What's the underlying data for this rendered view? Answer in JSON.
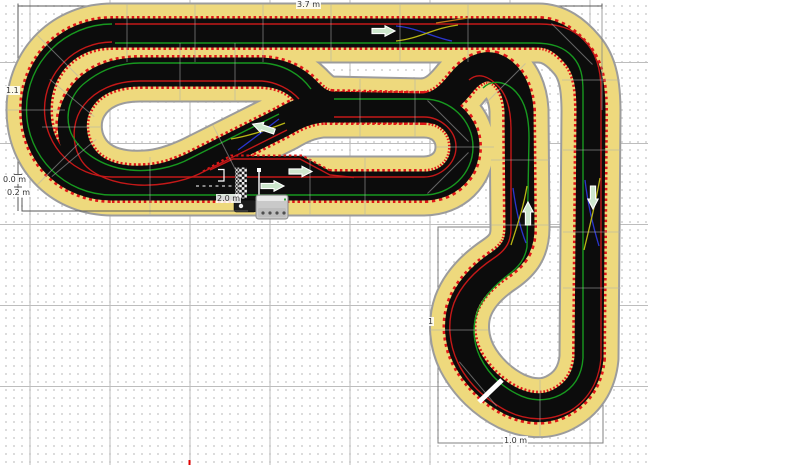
{
  "app": {
    "canvas_name": "slot-car-track-editor-canvas"
  },
  "colors": {
    "border_yellow": "#eed97d",
    "track_black": "#0c0c0c",
    "track_outline": "#9c9c9c",
    "rumble_red": "#e01818",
    "lane_red": "#c41818",
    "lane_green": "#17981f",
    "lanechange_blue": "#2a35cc",
    "lanechange_yellow": "#b9b614",
    "lanechange_orange": "#c07818",
    "arrow_fill": "#cde7cd",
    "dimension_line": "#5a5a5a",
    "selection_rect": "#808080",
    "page_marker_red": "#e00000"
  },
  "dimension_labels": [
    {
      "text": "3.7 m",
      "x": 296,
      "y": 0
    },
    {
      "text": "1.1",
      "x": 5,
      "y": 86
    },
    {
      "text": "0.0 m",
      "x": 2,
      "y": 175
    },
    {
      "text": "0.2 m",
      "x": 6,
      "y": 188
    },
    {
      "text": "2.0 m",
      "x": 216,
      "y": 194
    },
    {
      "text": "1.0 m",
      "x": 503,
      "y": 436
    },
    {
      "text": "1",
      "x": 427,
      "y": 317
    }
  ],
  "track": {
    "main_loop_d": "M 112 186 L 424 186 C 448 186 465 169 465 147 C 465 125 448 108 424 108 L 322 108 C 305 110 295 115 283 122 L 195 166 C 178 174 163 179 146 180 C 112 182 90 172 79 152 C 70 136 70 116 79 101 C 90 82 112 72 140 72 L 262 72 C 282 73 295 80 305 90 C 312 97 318 104 330 106 L 424 108 C 443 106 454 92 462 82 C 472 70 486 62 499 70 C 512 78 518 94 519 110 L 520 228 C 520 246 513 255 500 264 C 482 276 469 290 463 306 C 457 323 459 342 467 358 C 477 377 493 392 511 401 C 528 409 545 410 559 403 C 577 394 587 379 589 358 L 591 112 C 591 86 588 68 577 55 C 566 42 554 33 538 33 L 112 33 C 70 33 36 64 36 110 C 36 156 70 186 112 186 Z",
    "pit_strip_d": "M 203 172 L 231 156 L 302 156 L 332 172 Z",
    "pit_strip_dots_d": "M 203 171.5 L 231 155.5 L 302 155.5 L 332 171.5",
    "pit_red_d": "M 210 170 L 233 159 L 300 159 L 330 175 L 354 177.5",
    "lane_red_paths": [
      "M 115 24 L 540 24 C 558 24 572 28 584 40 C 596 52 601 70 601 90 L 601 358 C 599 382 588 400 570 411 C 549 422 526 421 505 410 C 485 399 468 383 458 363 C 449 344 447 322 454 303 C 461 285 476 270 494 258 C 506 250 511 242 511 228 L 511 130 C 511 112 508 97 499 87 C 489 76 478 72 469 80",
      "M 334 117 L 424 117 C 440 117 456 130 456 147 C 456 164 440 177 424 177 L 112 177 C 75 177 44.5 147 44.5 109.5 C 44.5 72 75 42 112 42",
      "M 287 130 L 199 174 C 182 182 158 186 138 185 C 108 183 86 172 79 156 C 71 140 73 119 84 105 C 95 91 114 81 140 81 L 262 81 C 276 82 290 89 299 99"
    ],
    "lane_green_paths": [
      "M 115 43 L 534 43 C 552 43 564 47 573 57 C 581 66 583 76 583 92 L 583 358 C 582 375 574 388 560 395 C 546 402 530 401 517 394 C 501 386 488 373 480 357 C 473 342 472 325 478 310 C 484 296 495 285 508 275 C 519 267 525 259 527 247 L 529 138 C 529 116 525 102 516 92 C 506 81 492 79 483 88",
      "M 334 99 L 424 99 C 450 99 473 120 473 147 C 473 174 450 195 424 195 L 112 195 C 65 195 26.5 157 26.5 109.5 C 26.5 62 65 24 112 24",
      "M 279 114 L 191 158 C 173 168 150 172 130 170 C 101 167 79 151 71 133 C 64 115 70 94 86 82 C 101 70 118 63 140 63 L 262 63 C 284 64 301 75 311 89"
    ],
    "center_dashes_d": "M 196 186 L 237 186",
    "lane_changes": [
      {
        "color": "lanechange_blue",
        "d": "M 396 26 C 418 28 432 37 452 41"
      },
      {
        "color": "lanechange_yellow",
        "d": "M 396 41 C 418 39 434 28 458 25"
      },
      {
        "color": "lanechange_orange",
        "d": "M 436 23 L 468 18"
      },
      {
        "color": "lanechange_blue",
        "d": "M 513 188 C 516 210 520 228 526 243"
      },
      {
        "color": "lanechange_yellow",
        "d": "M 527 186 C 523 210 516 229 511 245"
      },
      {
        "color": "lanechange_blue",
        "d": "M 585 180 C 588 206 593 226 599 246"
      },
      {
        "color": "lanechange_yellow",
        "d": "M 600 178 C 595 206 589 229 584 250"
      },
      {
        "color": "lanechange_blue",
        "d": "M 238 150 C 252 140 267 128 279 119"
      },
      {
        "color": "lanechange_yellow",
        "d": "M 231 139 C 249 136 267 130 285 123"
      }
    ],
    "joints": [
      {
        "x": 127,
        "y": 33,
        "a": 90
      },
      {
        "x": 195,
        "y": 33,
        "a": 90
      },
      {
        "x": 263,
        "y": 33,
        "a": 90
      },
      {
        "x": 331,
        "y": 33,
        "a": 90
      },
      {
        "x": 400,
        "y": 33,
        "a": 90
      },
      {
        "x": 468,
        "y": 33,
        "a": 90
      },
      {
        "x": 150,
        "y": 186,
        "a": 90
      },
      {
        "x": 310,
        "y": 186,
        "a": 90
      },
      {
        "x": 365,
        "y": 186,
        "a": 90
      },
      {
        "x": 180,
        "y": 72,
        "a": 90
      },
      {
        "x": 235,
        "y": 72,
        "a": 90
      },
      {
        "x": 360,
        "y": 108,
        "a": 90
      },
      {
        "x": 415,
        "y": 108,
        "a": 90
      },
      {
        "x": 520,
        "y": 160,
        "a": 0
      },
      {
        "x": 520,
        "y": 225,
        "a": 0
      },
      {
        "x": 592,
        "y": 150,
        "a": 0
      },
      {
        "x": 592,
        "y": 232,
        "a": 0
      },
      {
        "x": 592,
        "y": 288,
        "a": 0
      },
      {
        "x": 58,
        "y": 56,
        "a": 45
      },
      {
        "x": 36,
        "y": 110,
        "a": 0
      },
      {
        "x": 58,
        "y": 164,
        "a": 135
      },
      {
        "x": 72,
        "y": 98,
        "a": 40
      },
      {
        "x": 71,
        "y": 127,
        "a": 0
      },
      {
        "x": 74,
        "y": 158,
        "a": 140
      },
      {
        "x": 448,
        "y": 121,
        "a": 45
      },
      {
        "x": 465,
        "y": 147,
        "a": 0
      },
      {
        "x": 448,
        "y": 173,
        "a": 135
      },
      {
        "x": 459,
        "y": 330,
        "a": 0
      },
      {
        "x": 478,
        "y": 384,
        "a": 50
      },
      {
        "x": 540,
        "y": 409,
        "a": 90
      },
      {
        "x": 572,
        "y": 44,
        "a": 45
      },
      {
        "x": 591,
        "y": 80,
        "a": 0
      },
      {
        "x": 505,
        "y": 84,
        "a": 135
      },
      {
        "x": 226,
        "y": 151,
        "a": 63
      }
    ],
    "joint_gap_white": {
      "x1": 479,
      "y1": 402,
      "x2": 502,
      "y2": 380
    },
    "direction_arrows": [
      {
        "x": 383,
        "y": 31,
        "r": 0
      },
      {
        "x": 300,
        "y": 171.5,
        "r": 0
      },
      {
        "x": 272,
        "y": 186,
        "r": 0
      },
      {
        "x": 264,
        "y": 128,
        "r": 199
      },
      {
        "x": 528,
        "y": 214,
        "r": 270
      },
      {
        "x": 593,
        "y": 197,
        "r": 90
      }
    ],
    "arrow_shape_d": "M -11 -2.6 L 2 -2.6 L 2 -5.2 L 12 0 L 2 5.2 L 2 2.6 L -11 2.6 Z"
  },
  "start_finish": {
    "checker_rect": {
      "x": 239,
      "y": 167.5,
      "w": 8,
      "h": 31
    },
    "ladder_rect": {
      "x": 235.2,
      "y": 167.5,
      "w": 3.6,
      "h": 31
    },
    "start_line": {
      "x": 259,
      "y1": 168,
      "y2": 197
    },
    "start_square": {
      "x": 257,
      "y": 168,
      "w": 4,
      "h": 4
    },
    "bracket_d": "M 218 169.5 L 224 169.5 L 224 181 L 218 181",
    "power_base": {
      "x": 256,
      "y": 195,
      "w": 32,
      "h": 24,
      "dot_y": 213,
      "dot_xs": [
        263,
        270,
        277,
        284
      ],
      "led": {
        "x": 284,
        "y": 198.5
      }
    },
    "connector": {
      "x": 234,
      "y": 200,
      "w": 22,
      "h": 12,
      "plug": {
        "x": 241,
        "y": 206
      }
    }
  },
  "measurements": {
    "top_line": {
      "x1": 18,
      "y1": 6,
      "x2": 602,
      "y2": 6
    },
    "left_line": {
      "x1": 18,
      "y1": 6,
      "x2": 18,
      "y2": 211
    },
    "tick_a": {
      "x1": 14,
      "y1": 174.5,
      "x2": 22,
      "y2": 174.5
    },
    "tick_b": {
      "x1": 14,
      "y1": 187,
      "x2": 22,
      "y2": 187
    },
    "bottom_l_d": "M 22 198 L 22 211 L 248 211",
    "right_edge": {
      "x1": 602,
      "y1": 6,
      "x2": 602,
      "y2": 110
    },
    "teardrop_rect": {
      "x": 438,
      "y": 227,
      "w": 165,
      "h": 216
    },
    "page_marker": {
      "x": 189.5,
      "y1": 460,
      "y2": 465
    }
  }
}
